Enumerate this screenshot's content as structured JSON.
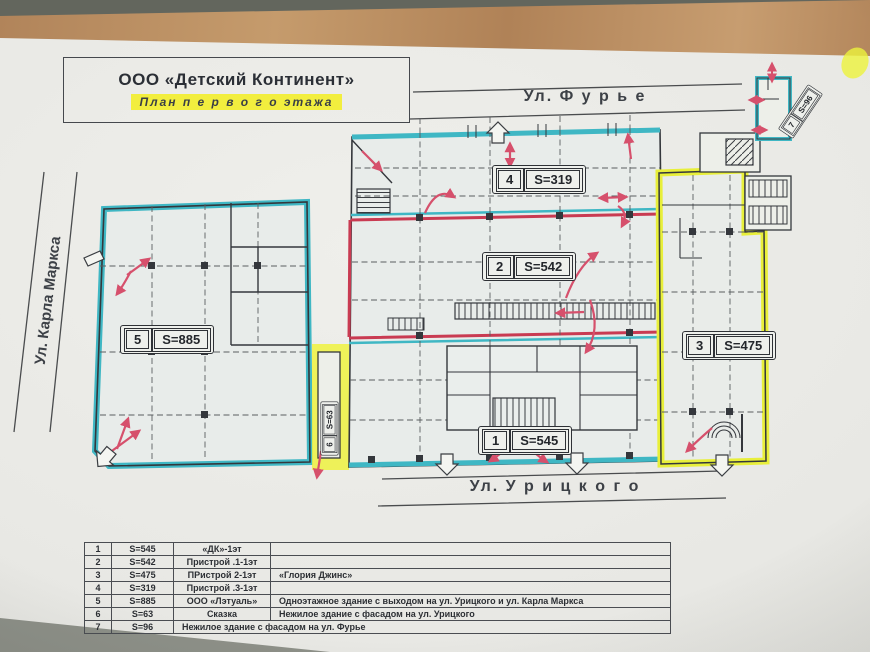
{
  "title_block": {
    "company": "ООО «Детский Континент»",
    "subtitle": "План  п е р в о г о  этажа"
  },
  "streets": {
    "top": "Ул. Ф у р ь е",
    "left": "Ул. Карла Маркса",
    "bottom": "Ул. У р и ц к о г о"
  },
  "area_labels": [
    {
      "num": "1",
      "area": "S=545"
    },
    {
      "num": "2",
      "area": "S=542"
    },
    {
      "num": "3",
      "area": "S=475"
    },
    {
      "num": "4",
      "area": "S=319"
    },
    {
      "num": "5",
      "area": "S=885"
    },
    {
      "num": "6",
      "area": "S=63"
    },
    {
      "num": "7",
      "area": "S=96"
    }
  ],
  "legend": [
    {
      "num": "1",
      "area": "S=545",
      "name": "«ДК»-1эт",
      "desc": ""
    },
    {
      "num": "2",
      "area": "S=542",
      "name": "Пристрой .1-1эт",
      "desc": ""
    },
    {
      "num": "3",
      "area": "S=475",
      "name": "ПРистрой 2-1эт",
      "desc": "«Глория Джинс»"
    },
    {
      "num": "4",
      "area": "S=319",
      "name": "Пристрой .3-1эт",
      "desc": ""
    },
    {
      "num": "5",
      "area": "S=885",
      "name": "ООО «Лэтуаль»",
      "desc": "Одноэтажное здание  с выходом на ул. Урицкого и ул. Карла Маркса"
    },
    {
      "num": "6",
      "area": "S=63",
      "name": "Сказка",
      "desc": "Нежилое здание  с фасадом на ул. Урицкого"
    },
    {
      "num": "7",
      "area": "S=96",
      "name": "Нежилое здание с фасадом на ул. Фурье",
      "desc": ""
    }
  ],
  "colors": {
    "cyan_outline": "#3fb7c4",
    "yellow_highlight": "#ecf23c",
    "red_line": "#c93b52",
    "arrow_pink": "#d6506c",
    "ink": "#34373c",
    "paper": "#e9e9e5",
    "wood": "#b68a5c",
    "backdrop": "#6e7168",
    "subtitle_highlight": "#f2ee3e"
  }
}
